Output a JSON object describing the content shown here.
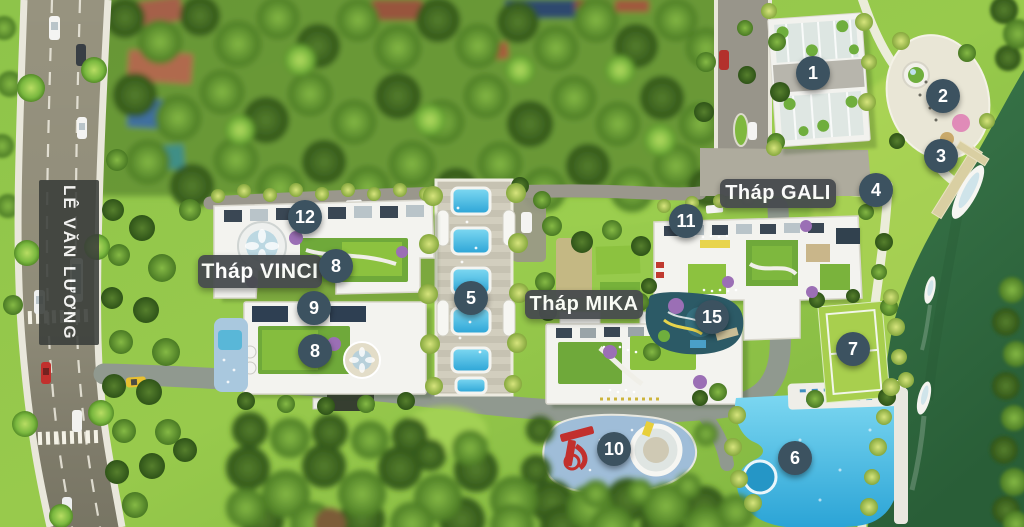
{
  "map": {
    "road_label": "LÊ VĂN LƯƠNG",
    "towers": [
      {
        "id": "vinci",
        "label": "Tháp VINCI"
      },
      {
        "id": "mika",
        "label": "Tháp MIKA"
      },
      {
        "id": "gali",
        "label": "Tháp GALI"
      }
    ],
    "markers": [
      {
        "num": "1",
        "x": 813,
        "y": 73
      },
      {
        "num": "2",
        "x": 943,
        "y": 96
      },
      {
        "num": "3",
        "x": 941,
        "y": 156
      },
      {
        "num": "4",
        "x": 876,
        "y": 190
      },
      {
        "num": "5",
        "x": 471,
        "y": 298
      },
      {
        "num": "6",
        "x": 795,
        "y": 458
      },
      {
        "num": "7",
        "x": 853,
        "y": 349
      },
      {
        "num": "8",
        "x": 336,
        "y": 266
      },
      {
        "num": "8",
        "x": 315,
        "y": 351
      },
      {
        "num": "9",
        "x": 314,
        "y": 308
      },
      {
        "num": "10",
        "x": 614,
        "y": 449
      },
      {
        "num": "11",
        "x": 686,
        "y": 221
      },
      {
        "num": "12",
        "x": 305,
        "y": 217
      },
      {
        "num": "15",
        "x": 712,
        "y": 317
      }
    ],
    "colors": {
      "marker_bg": "#3c5260",
      "label_bg": "#474b4e",
      "roadlabel_bg": "#3a3e3a",
      "label_text": "#ffffff",
      "river": "#2e6a40",
      "pool": "#3db9e5",
      "grass": "#8ec44a"
    }
  }
}
